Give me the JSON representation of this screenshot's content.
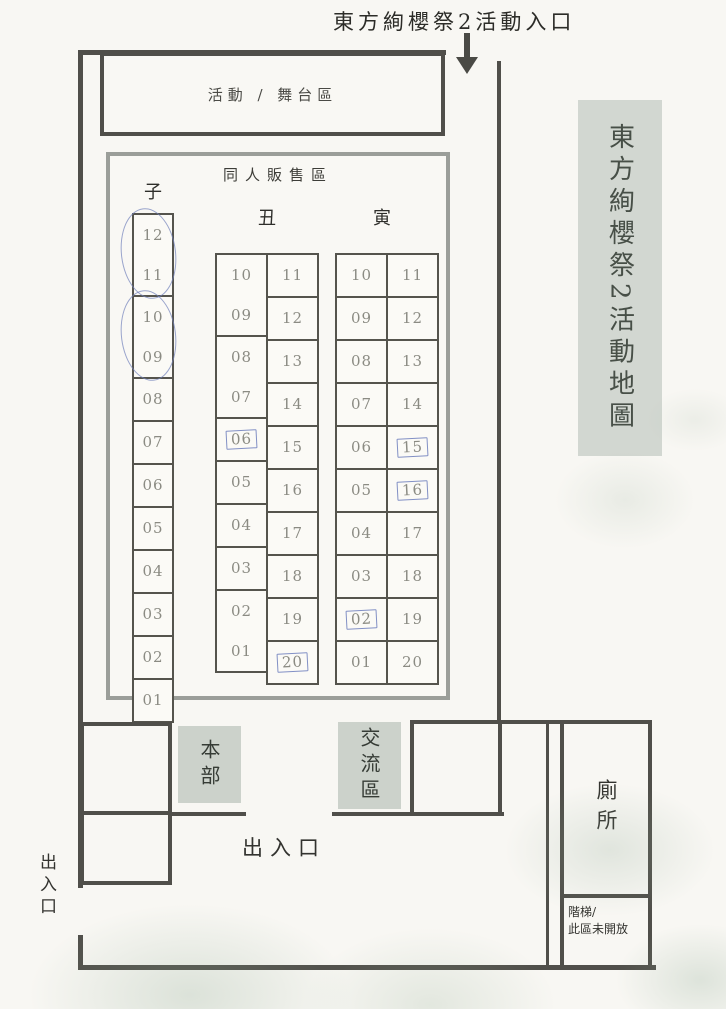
{
  "header": {
    "entrance_label": "東方絢櫻祭2活動入口"
  },
  "side_title": {
    "text": "東方絢櫻祭2活動地圖"
  },
  "stage": {
    "label": "活動 / 舞台區"
  },
  "sales": {
    "label": "同人販售區",
    "columns": [
      {
        "id": "zi",
        "label": "子",
        "subcolumns": [
          {
            "groups": [
              {
                "cells": [
                  "12",
                  "11"
                ],
                "mark": "circle"
              },
              {
                "cells": [
                  "10",
                  "09"
                ],
                "mark": "circle"
              },
              {
                "cells": [
                  "08"
                ]
              },
              {
                "cells": [
                  "07"
                ]
              },
              {
                "cells": [
                  "06"
                ]
              },
              {
                "cells": [
                  "05"
                ]
              },
              {
                "cells": [
                  "04"
                ]
              },
              {
                "cells": [
                  "03"
                ]
              },
              {
                "cells": [
                  "02"
                ]
              },
              {
                "cells": [
                  "01"
                ]
              }
            ]
          }
        ]
      },
      {
        "id": "chou",
        "label": "丑",
        "subcolumns": [
          {
            "groups": [
              {
                "cells": [
                  "10",
                  "09"
                ]
              },
              {
                "cells": [
                  "08",
                  "07"
                ]
              },
              {
                "cells": [
                  "06"
                ],
                "mark": "box"
              },
              {
                "cells": [
                  "05"
                ]
              },
              {
                "cells": [
                  "04"
                ]
              },
              {
                "cells": [
                  "03"
                ]
              },
              {
                "cells": [
                  "02",
                  "01"
                ]
              }
            ]
          },
          {
            "groups": [
              {
                "cells": [
                  "11"
                ]
              },
              {
                "cells": [
                  "12"
                ]
              },
              {
                "cells": [
                  "13"
                ]
              },
              {
                "cells": [
                  "14"
                ]
              },
              {
                "cells": [
                  "15"
                ]
              },
              {
                "cells": [
                  "16"
                ]
              },
              {
                "cells": [
                  "17"
                ]
              },
              {
                "cells": [
                  "18"
                ]
              },
              {
                "cells": [
                  "19"
                ]
              },
              {
                "cells": [
                  "20"
                ],
                "mark": "box"
              }
            ]
          }
        ]
      },
      {
        "id": "yin",
        "label": "寅",
        "subcolumns": [
          {
            "groups": [
              {
                "cells": [
                  "10"
                ]
              },
              {
                "cells": [
                  "09"
                ]
              },
              {
                "cells": [
                  "08"
                ]
              },
              {
                "cells": [
                  "07"
                ]
              },
              {
                "cells": [
                  "06"
                ]
              },
              {
                "cells": [
                  "05"
                ]
              },
              {
                "cells": [
                  "04"
                ]
              },
              {
                "cells": [
                  "03"
                ]
              },
              {
                "cells": [
                  "02"
                ],
                "mark": "box"
              },
              {
                "cells": [
                  "01"
                ]
              }
            ]
          },
          {
            "groups": [
              {
                "cells": [
                  "11"
                ]
              },
              {
                "cells": [
                  "12"
                ]
              },
              {
                "cells": [
                  "13"
                ]
              },
              {
                "cells": [
                  "14"
                ]
              },
              {
                "cells": [
                  "15"
                ],
                "mark": "box"
              },
              {
                "cells": [
                  "16"
                ],
                "mark": "box"
              },
              {
                "cells": [
                  "17"
                ]
              },
              {
                "cells": [
                  "18"
                ]
              },
              {
                "cells": [
                  "19"
                ]
              },
              {
                "cells": [
                  "20"
                ]
              }
            ]
          }
        ]
      }
    ]
  },
  "facilities": {
    "hq": "本部",
    "exchange": "交流區",
    "toilet": "廁所",
    "stairs_line1": "階梯/",
    "stairs_line2": "此區未開放",
    "exit_main": "出入口",
    "exit_side": "出入口"
  },
  "colors": {
    "wall": "#504f4a",
    "booth_border": "#55544d",
    "panel_bg": "#ccd2cb",
    "pen_annotation": "#7080ba",
    "paper": "#f8f7f3"
  }
}
